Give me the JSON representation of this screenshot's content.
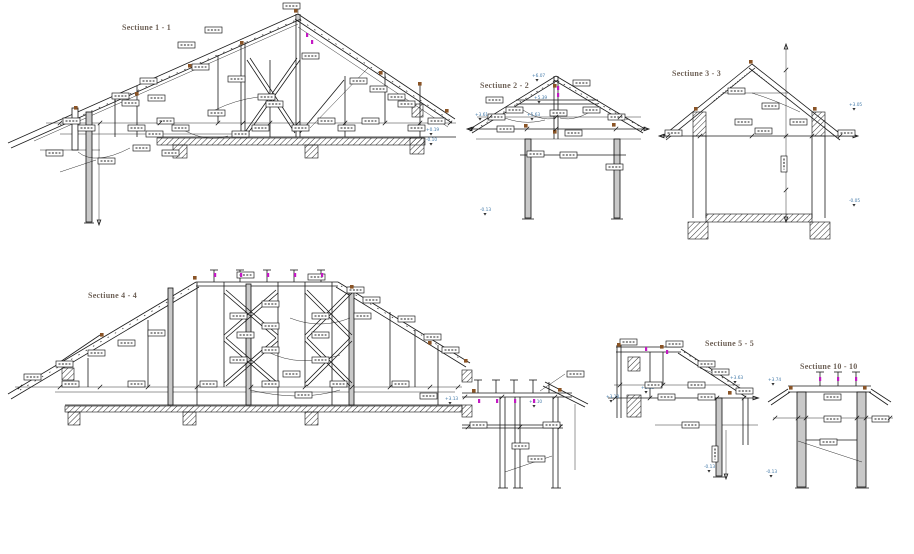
{
  "page": {
    "background": "#ffffff"
  },
  "palette": {
    "line": "#1a1a1a",
    "title_text": "#6e6157",
    "elevation_text": "#4279a8",
    "joint_brown": "#8a5426",
    "accent_magenta": "#c319c3",
    "member_gray": "#c9c9c9"
  },
  "sections": {
    "s1": {
      "title": "Sectiune 1 - 1",
      "elevations": [
        "+0.19",
        "-0.10"
      ]
    },
    "s2": {
      "title": "Sectiune 2 - 2",
      "elevations": [
        "+6.07",
        "+5.39",
        "+3.61",
        "+5.63",
        "-0.13"
      ]
    },
    "s3": {
      "title": "Sectiune 3 - 3",
      "elevations": [
        "+3.05",
        "-0.05"
      ]
    },
    "s4": {
      "title": "Sectiune 4 - 4",
      "elevations": [
        "+3.13",
        "+3.10"
      ]
    },
    "s5": {
      "title": "Sectiune 5 - 5",
      "elevations": [
        "+3.13",
        "+3.18",
        "+3.63",
        "-0.13"
      ]
    },
    "s10": {
      "title": "Sectiune 10 - 10",
      "elevations": [
        "+3.74",
        "-0.13"
      ]
    }
  }
}
